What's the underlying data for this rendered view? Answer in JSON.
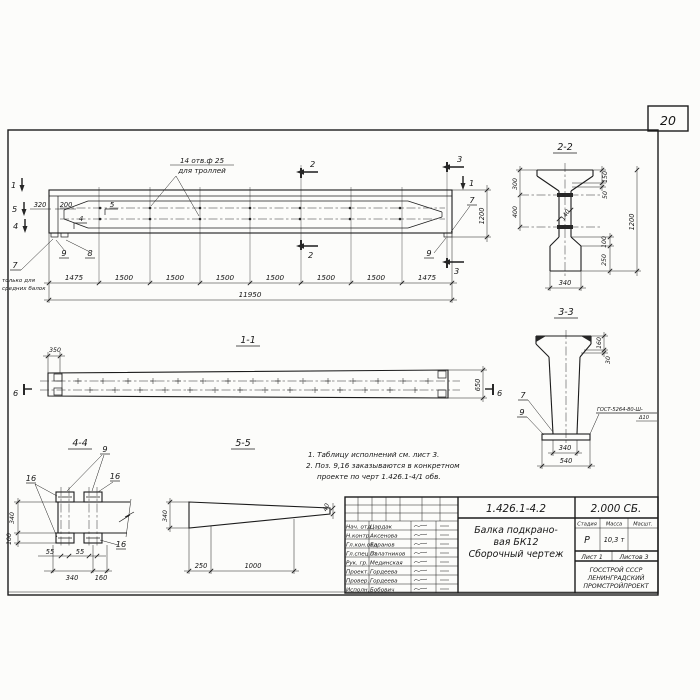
{
  "page_number": "20",
  "ev": {
    "holes1": "14 отв.ф 25",
    "holes2": "для троллей",
    "m1": "1",
    "m2": "2",
    "m3": "3",
    "m4": "4",
    "m5": "5",
    "p4": "4",
    "p5": "5",
    "p7": "7",
    "p8": "8",
    "p9": "9",
    "only1": "только для",
    "only2": "средних балок",
    "d320": "320",
    "d200": "200",
    "d1200": "1200",
    "seg": [
      "1475",
      "1500",
      "1500",
      "1500",
      "1500",
      "1500",
      "1500",
      "1475"
    ],
    "total": "11950"
  },
  "s22": {
    "label": "2-2",
    "d300": "300",
    "d400": "400",
    "d150": "150",
    "d50": "50",
    "d140": "140",
    "d1200": "1200",
    "d100": "100",
    "d250": "250",
    "d340": "340"
  },
  "s33": {
    "label": "3-3",
    "d160": "160",
    "d30": "30",
    "c7": "7",
    "c9": "9",
    "gost1": "ГОСТ-5264-80-Ш-",
    "gost2": "Δ10",
    "d340": "340",
    "d540": "540"
  },
  "s11": {
    "label": "1-1",
    "d350": "350",
    "d650": "650",
    "m6": "6"
  },
  "s44": {
    "label": "4-4",
    "c9": "9",
    "c16": "16",
    "d340": "340",
    "d100": "100",
    "d55": "55",
    "db340": "340",
    "d160": "160"
  },
  "s55": {
    "label": "5-5",
    "d340": "340",
    "d250": "250",
    "d1000": "1000",
    "d40": "40"
  },
  "notes": [
    "1. Таблицу исполнений см. лист 3.",
    "2. Поз. 9,16 заказываются в конкретном",
    "проекте по черт 1.426.1-4/1 обв."
  ],
  "tb": {
    "num": "1.426.1-4.2",
    "code": "2.000 СБ.",
    "t1": "Балка подкрано-",
    "t2": "вая БК12",
    "t3": "Сборочный чертеж",
    "h_stage": "Стадия",
    "h_mass": "Масса",
    "h_scale": "Масшт.",
    "v_stage": "Р",
    "v_mass": "10,3 т",
    "sheet": "Лист 1",
    "sheets": "Листов 3",
    "org1": "ГОССТРОЙ СССР",
    "org2": "ЛЕНИНГРАДСКИЙ",
    "org3": "ПРОМСТРОЙПРОЕКТ",
    "rows": [
      {
        "role": "Нач. отд",
        "name": "Цардак"
      },
      {
        "role": "Н.контр.",
        "name": "Аксенова"
      },
      {
        "role": "Гл.кон.отд",
        "name": "Баранов"
      },
      {
        "role": "Гл.спец.от",
        "name": "Палатников"
      },
      {
        "role": "Рук. гр.",
        "name": "Мединская"
      },
      {
        "role": "Проект.",
        "name": "Гордеева"
      },
      {
        "role": "Провер.",
        "name": "Гордеева"
      },
      {
        "role": "Исполн.",
        "name": "Бобович"
      }
    ]
  }
}
